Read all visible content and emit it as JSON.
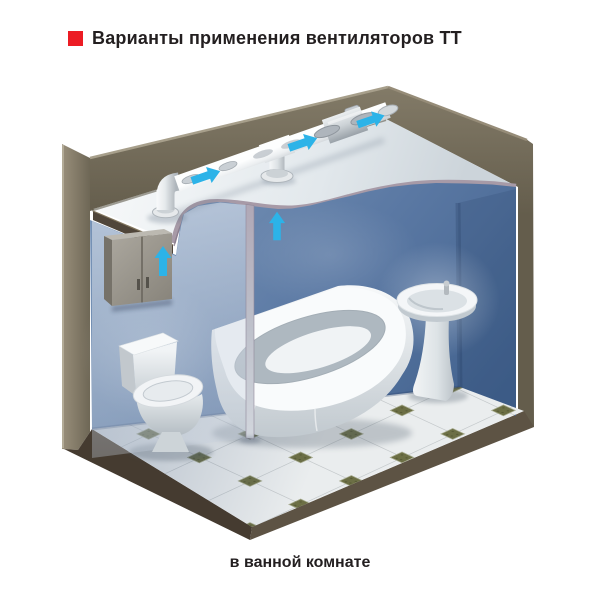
{
  "title": {
    "text": "Варианты применения вентиляторов ТТ",
    "bullet_color": "#ec1c24"
  },
  "caption": {
    "text": "в ванной комнате"
  },
  "scene": {
    "type": "3d-cutaway-illustration",
    "subject": "bathroom ventilated by an inline TT duct fan installed above the ceiling",
    "airflow_arrows": {
      "count": 5,
      "on_duct": 3,
      "through_ceiling_vent": 1,
      "at_cabinet_fan_unit": 1
    },
    "objects": [
      "exhaust duct run above suspended ceiling",
      "inline TT duct fan",
      "duct elbow with ceiling flange",
      "duct tee branch with ceiling flange",
      "duct outlet through outer wall",
      "wall cabinet concealing fan connection",
      "toilet",
      "corner bathtub",
      "pedestal washbasin",
      "translucent cutaway wall",
      "octagonal tile floor with green inserts"
    ],
    "colors": {
      "arrow": "#2cb3e8",
      "outer_wall": "#756d5b",
      "inner_wall_blue": "#53719c",
      "ceiling": "#e9eef1",
      "ceiling_cut_edge": "#a79aa7",
      "floor_tile": "#eaedee",
      "floor_accent_tile": "#6c6f45",
      "floor_slab": "#4b4135",
      "duct_metal": "#d9dde0",
      "sanitary_white": "#f5f7f8",
      "cabinet_gray": "#9d9990"
    }
  }
}
